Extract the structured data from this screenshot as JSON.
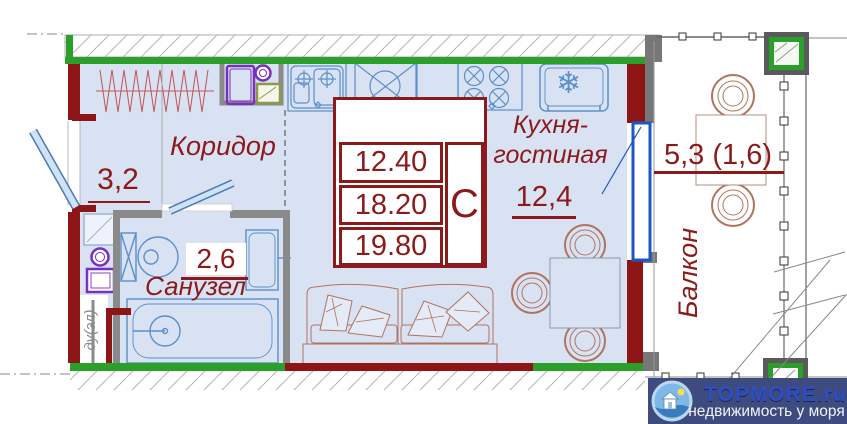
{
  "plan_labels": {
    "corridor": {
      "name": "Коридор",
      "area": "3,2"
    },
    "bathroom": {
      "name": "Санузел",
      "area": "2,6"
    },
    "kitchen_living": {
      "name": "Кухня-\nгостиная",
      "area": "12,4"
    },
    "balcony": {
      "name": "Балкон",
      "area": "5,3 (1,6)"
    },
    "shaft": "ду(эл)"
  },
  "info_box": {
    "values": [
      "12.40",
      "18.20",
      "19.80"
    ],
    "type_letter": "С"
  },
  "icons": {
    "snowflake": "❄"
  },
  "watermark": {
    "brand": "TOPMORE.ru",
    "tagline": "недвижимость у моря"
  },
  "colors": {
    "wall_red": "#8e1515",
    "wall_green": "#2aa02a",
    "wall_gray": "#8a8a8a",
    "room_fill": "#d9e2f3",
    "label_red": "#8b1b1b",
    "fixture_blue": "#5b8fc9",
    "door_blue": "#1e56c8",
    "furniture_brown": "#b0735e",
    "appliance_purple": "#7b2fbe",
    "appliance_olive": "#8a9a4a",
    "logo_bg": "#3d4b7e",
    "logo_blue": "#2e4ec4"
  }
}
